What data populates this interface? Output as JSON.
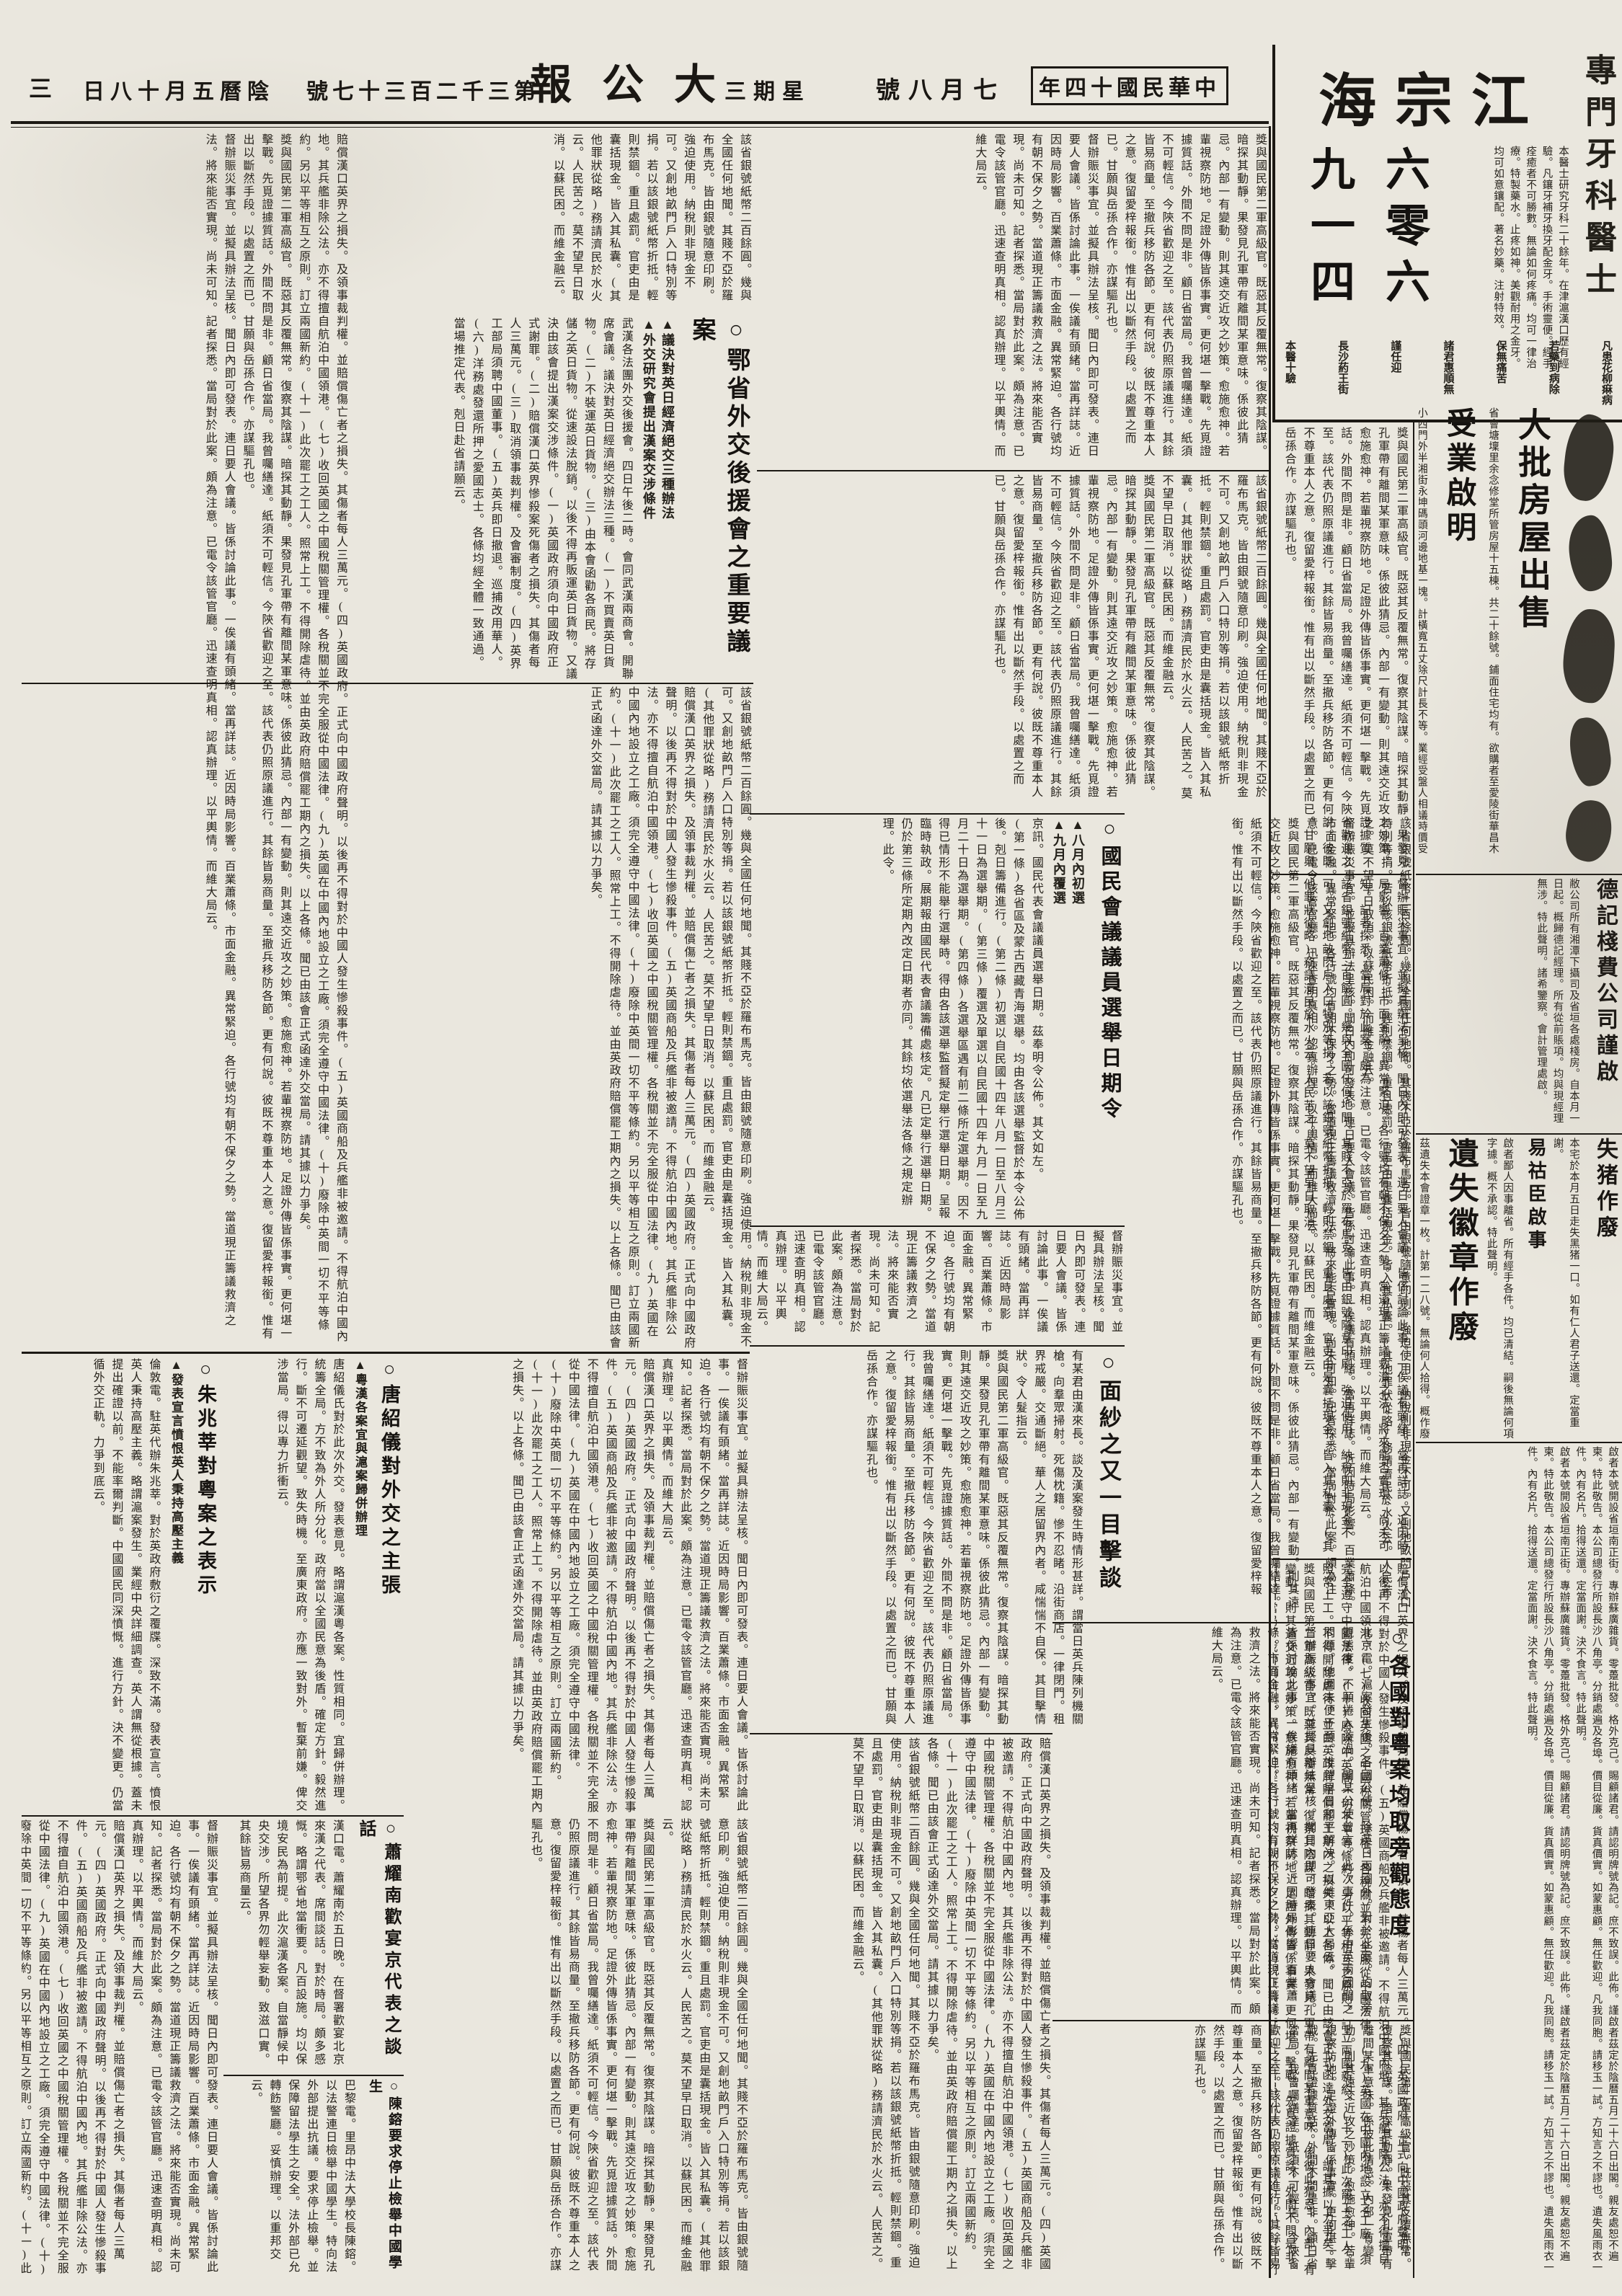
{
  "masthead": {
    "era_date": "中華民國十四年",
    "date": "七月八號",
    "weekday": "星期三",
    "paper_name": "大公報",
    "issue_no": "第三千二百三十七號",
    "lunar_date": "陰曆五月十八日",
    "page_no": "三"
  },
  "dentist_ad": {
    "profession": "專門牙科醫士",
    "name": "江宗海",
    "phone_cols": [
      "六零六",
      "九一四"
    ],
    "phone": "六零六九一四",
    "body": "本醫士研究牙科二十餘年。在津滬漢口歷有經驗。凡鑲牙補牙換牙配金牙。手術靈便。經手痊癒者不可勝數。無論如何疼痛。均可一律治療。特製藥水。止疼如神。美觀耐用之金牙。均可如意鑲配。著名妙藥。注射特效。",
    "footer_items": [
      "本醫十驗",
      "長沙葯王街",
      "謹任迎",
      "諸君惠順無",
      "保無痛苦",
      "若藥到病除",
      "凡患花柳痳病"
    ]
  },
  "right_ads": {
    "house_sale": {
      "headline": "大批房屋出售",
      "body": "省會塘壈里余念修堂所管房屋十五棟。共二十餘號。鋪面住宅均有。欲購者至愛陵街華昌木號。問余雲卿接洽不誤。"
    },
    "land_notice": {
      "headline": "受業啟明",
      "body": "小西門外半湘街永坤碼頭河邊地基一塊。計橫寬五丈除尺計長不等。業經受盤人相議時價受買。如有上首糾葛不清。均歸出業人擔承。不與受業人相涉。特此聲明。"
    },
    "deji": {
      "headline": "德記棧費公司謹啟",
      "body": "敝公司所有湘潭下攝司及省垣各處棧房。自本月一日起。概歸德記經理。所有從前賬項。均與現經理無涉。特此聲明。諸希鑒察。會計管理處啟。"
    },
    "lost_pig": {
      "headline": "失猪作廢",
      "body": "本宅於本月五日走失黑猪一口。如有仁人君子送還。定當重謝。"
    },
    "yihuchen": {
      "headline": "易祜臣啟事",
      "body": "啟者鄙人因事離省。所有經手各件。均已清結。嗣後無論何項字據。概不承認。特此聲明。"
    },
    "lost_badge": {
      "headline": "遺失徽章作廢",
      "body": "茲遺失本會證章一枚。計第一二八號。無論何人拾得。概作廢紙。不能為憑。特此登報聲明。"
    },
    "classified": "啟者本號開設省垣南正街。專辦蘇廣雜貨。零躉批發。格外克己。賜顧諸君。請認明牌號為記。庶不致誤。此佈。謹啟者茲定於陰曆五月二十六日出閣。親友處恕不遍柬。特此敬告。本公司總發行所設長沙八角亭。分銷處遍及各埠。價目從廉。貨真價實。如蒙惠顧。無任歡迎。凡我同胞。請移玉一試。方知言之不謬也。遺失風雨衣一件。內有名片。拾得送還。定當面謝。決不食言。特此聲明。"
  },
  "articles": {
    "houyuanhui": {
      "headline": "○鄂省外交後援會之重要議案",
      "subheads": [
        "▲議決對英日經濟絕交三種辦法",
        "▲外交研究會提出漢案交涉條件"
      ],
      "body": "武漢各法團外交後援會。四日午後二時。會同武漢兩商會。開聯席會議。議決對英日經濟絕交辦法三種。(一)不買賣英日貨物。(二)不裝運英日貨物。(三)由本會函勸各商民。將存儲之英日貨物。從速設法脫銷。以後不得再販運英日貨物。又議決由該會提出漢案交涉條件。(一)英國政府須向中國政府正式謝罪。(二)賠償漢口英界慘殺案死傷者之損失。其傷者每人三萬元。(三)取消領事裁判權。及會審制度。(四)英界工部局須聘中國董事。(五)英兵即日撤退。巡捕改用華人。(六)洋務處發還所押之愛國志士。各條均經全體一致通過。當場推定代表。剋日赴省請願云。"
    },
    "election": {
      "headline": "○國民會議議員選舉日期令",
      "subheads": [
        "▲八月內初選",
        "▲九月內覆選"
      ],
      "lead": "京訊。國民代表會議議員選舉日期。茲奉明令公佈。其文如左。",
      "body": "(第一條)各省區及蒙古西藏青海選舉。均由各該選舉監督於本令公佈後。剋日籌備進行。(第二條)初選以自民國十四年八月一日至八月三十一日為選舉期。(第三條)覆選及單選以自民國十四年九月一日至九月二十日為選舉期。(第四條)各選舉區遇有前二條所定選舉期。因不得已情形不能舉行選舉時。得由各該選舉監督擬定舉行選舉日期。呈報臨時執政。展期報由國民代表會議籌備處核定。凡已定舉行選舉日期。仍於第三條所定期內改定日期者亦同。其餘均依選舉法各條之規定辦理。此令。"
    },
    "tang": {
      "headline": "○唐紹儀對外交之主張",
      "subheads": [
        "▲粵漢各案宜與滬案歸併辦理"
      ],
      "body": "唐紹儀氏對於此次外交。發表意見。略謂滬漢粵各案。性質相同。宜歸併辦理。統籌全局。方不致為外人所分化。政府當以全國民意為後盾。確定方針。毅然進行。斷不可遷延觀望。致失時機。至廣東政府。亦應一致對外。暫棄前嫌。俾交涉當局。得以專力折衝云。"
    },
    "zhu": {
      "headline": "○朱兆莘對粵案之表示",
      "subheads": [
        "▲發表宣言憤恨英人秉持高壓主義"
      ],
      "body": "倫敦電。駐英代辦朱兆莘。對於英政府敷衍之覆牒。深致不滿。發表宣言。憤恨英人秉持高壓主義。略謂滬案發生。業經中央詳細調查。英人謂無從根據。蓋未提出確證以前。不能率爾判斷。中國國民同深憤慨。進行方針。決不變更。仍當循外交正軌。力爭到底云。"
    },
    "xiao": {
      "headline": "○蕭耀南歡宴京代表之談話",
      "body": "漢口電。蕭耀南於五日晚。在督署歡宴北京來漢之代表。席間談話。對於時局。頗多感慨。略謂鄂省地當衝要。凡百設施。均以保境安民為前提。此次滬漢各案。自當靜候中央交涉。所望各界勿輕舉妄動。致滋口實。其餘皆易商量云。"
    },
    "chen": {
      "headline": "○陳鎔要求停止檢舉中國學生",
      "body": "巴黎電。里昂中法大學校長陳鎔。以法警連日檢舉中國學生。特向法外部提出抗議。要求停止檢舉。並保障留法學生之安全。法外部已允轉飭警廳。妥慎辦理。以重邦交云。"
    },
    "veil": {
      "headline": "○面紗之又一目擊談",
      "body": "有某君由漢來長。談及漢案發生時情形甚詳。謂當日英兵陳列機關槍。向羣眾掃射。死傷枕籍。慘不忍睹。沿街商店。一律閉門。租界戒嚴。交通斷絕。華人之居留界內者。咸惴惴不自保。其目擊情狀。令人髮指云。"
    },
    "powers": {
      "headline": "○各國對粵案均取旁觀態度",
      "body": "北京電。滬案發生後。各國公使。除英日兩國外。對於此案。均取旁觀態度。不願捲入漩渦。聞某公使曾言。此次事件。係中英兩國間之問題。他國未便干預。惟望早日和平解決。以維東亞大局云。"
    }
  },
  "fillers": {
    "f1": "賠償漢口英界之損失。及領事裁判權。並賠償傷亡者之損失。其傷者每人三萬元。(四)英國政府。正式向中國政府聲明。以後再不得對於中國人發生慘殺事件。(五)英國商船及兵艦非被邀請。不得航泊中國內地。其兵艦非除公法。亦不得擅自航泊中國領港。(七)收回英國之中國稅關管理權。各稅關並不完全服從中國法律。(九)英國在中國內地設立之工廠。須完全遵守中國法律。(十)廢除中英間一切不平等條約。另以平等相互之原則。訂立兩國新約。(十一)此次罷工之工人。照常上工。不得開除虐待。並由英政府賠償罷工期內之損失。以上各條。聞已由該會正式函達外交當局。請其據以力爭矣。",
    "f2": "獎與國民第二軍高級官。既惡其反覆無常。復察其陰謀。暗探其動靜。果發見孔軍帶有離間某軍意味。係彼此猜忌。內部一有變動。則其遠交近攻之妙策。愈施愈神。若輩視察防地。足證外傳皆係事實。更何堪一擊戰。先覓證據質話。外間不問是非。顧日省當局。我曾囑繕達。紙須不可輕信。今陝省歡迎之至。該代表仍照原議進行。其餘皆易商量。至撤兵移防各節。更有何說。彼既不尊重本人之意。復留愛梓報銜。惟有出以斷然手段。以處置之而已。甘願與岳孫合作。亦謀驅孔也。",
    "f3": "該省銀號紙幣二百餘圓。幾與全國任何地聞。其賤不亞於羅布馬克。皆由銀號隨意印刷。強迫使用。納稅則非現金不可。又創地畝門戶入口特別等捐。若以該銀號紙幣折抵。輕則禁錮。重且處罰。官吏由是囊括現金。皆入其私囊。(其他罪狀從略)務請濟民於水火云。人民苦之。莫不望早日取消。以蘇民困。而維金融云。",
    "f4": "督辦賑災事宜。並擬具辦法呈核。聞日內即可發表。連日要人會議。皆係討論此事。一俟議有頭緒。當再詳誌。近因時局影響。百業蕭條。市面金融。異常緊迫。各行號均有朝不保夕之勢。當道現正籌議救濟之法。將來能否實現。尚未可知。記者探悉。當局對於此案。頗為注意。已電令該管官廳。迅速查明真相。認真辦理。以平輿情。而維大局云。"
  }
}
